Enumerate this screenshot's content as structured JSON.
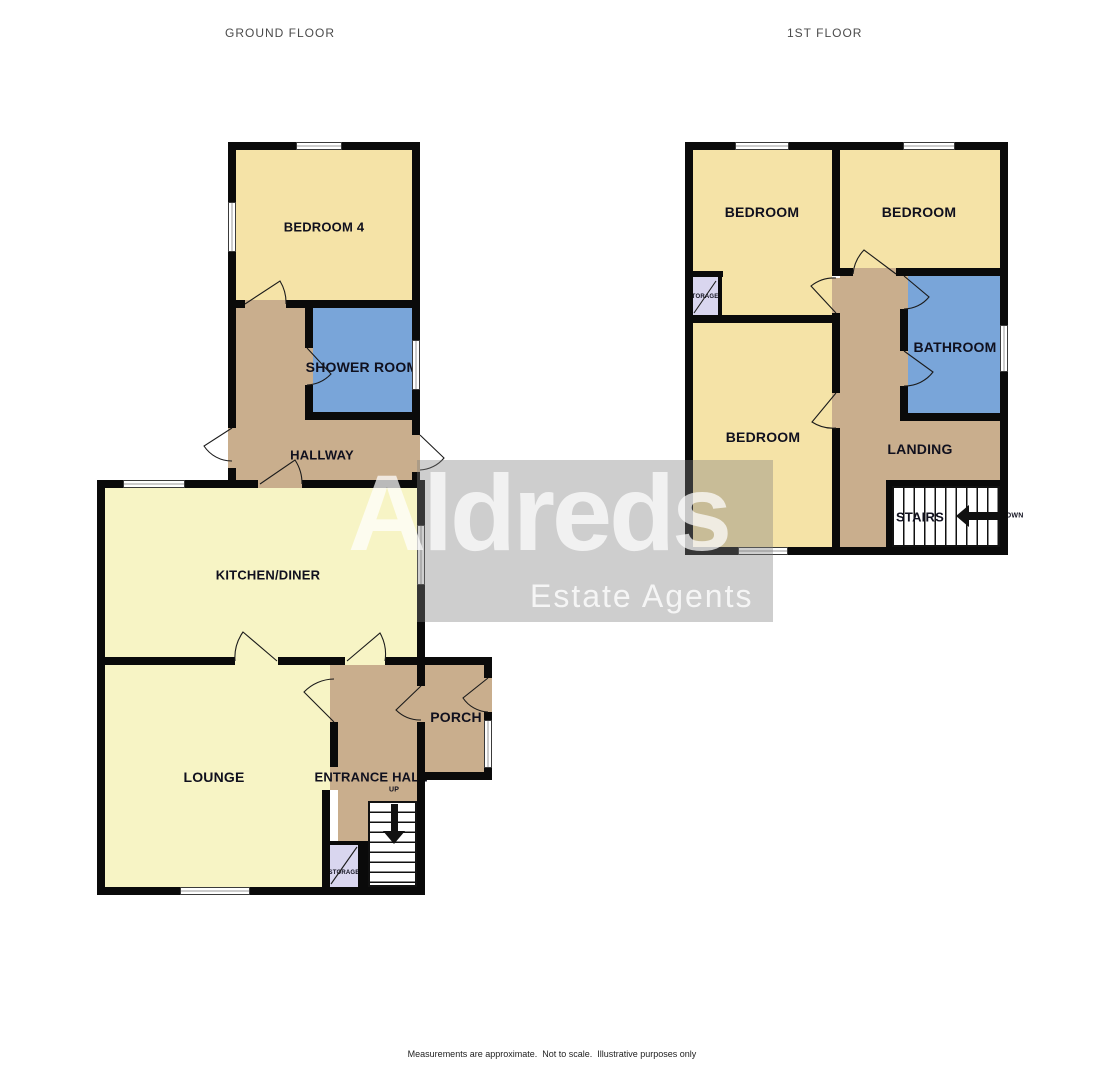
{
  "titles": {
    "ground": "GROUND FLOOR",
    "first": "1ST FLOOR"
  },
  "watermark": {
    "brand": "Aldreds",
    "tagline": "Estate Agents"
  },
  "footer": {
    "line1": "Measurements are approximate.  Not to scale.  Illustrative purposes only",
    "line2": "Made with Metropix ©2025"
  },
  "colors": {
    "wall": "#0a0a0a",
    "cream": "#F5E3A7",
    "pale": "#F7F4C5",
    "blue": "#79A5D9",
    "tan": "#C9AE8D",
    "lavender": "#D9D6EF"
  },
  "plans": [
    {
      "id": "ground-floor",
      "rooms": [
        {
          "id": "bedroom-4",
          "fill": "cream",
          "r": [
            236,
            150,
            176,
            150
          ]
        },
        {
          "id": "shower-room",
          "fill": "blue",
          "r": [
            313,
            308,
            99,
            104
          ]
        },
        {
          "id": "hallway-upper",
          "fill": "tan",
          "r": [
            236,
            308,
            69,
            112
          ]
        },
        {
          "id": "hallway-lower",
          "fill": "tan",
          "r": [
            236,
            420,
            176,
            60
          ]
        },
        {
          "id": "kitchen-diner",
          "fill": "pale",
          "r": [
            105,
            488,
            312,
            169
          ]
        },
        {
          "id": "lounge",
          "fill": "pale",
          "r": [
            105,
            665,
            225,
            222
          ]
        },
        {
          "id": "entrance-hall",
          "fill": "tan",
          "r": [
            338,
            665,
            79,
            222
          ]
        },
        {
          "id": "porch",
          "fill": "tan",
          "r": [
            425,
            665,
            59,
            107
          ]
        },
        {
          "id": "storage-ground",
          "fill": "lavender",
          "r": [
            330,
            845,
            28,
            42
          ]
        }
      ],
      "walls": [
        [
          228,
          142,
          68,
          8
        ],
        [
          342,
          142,
          78,
          8
        ],
        [
          228,
          142,
          8,
          60
        ],
        [
          228,
          252,
          8,
          176
        ],
        [
          228,
          468,
          8,
          20
        ],
        [
          412,
          142,
          8,
          198
        ],
        [
          412,
          390,
          8,
          45
        ],
        [
          412,
          472,
          8,
          16
        ],
        [
          228,
          300,
          17,
          8
        ],
        [
          286,
          300,
          126,
          8
        ],
        [
          305,
          308,
          8,
          40
        ],
        [
          305,
          385,
          8,
          27
        ],
        [
          305,
          412,
          107,
          8
        ],
        [
          97,
          480,
          161,
          8
        ],
        [
          302,
          480,
          123,
          8
        ],
        [
          97,
          480,
          8,
          185
        ],
        [
          417,
          480,
          8,
          45
        ],
        [
          417,
          585,
          8,
          80
        ],
        [
          97,
          657,
          138,
          8
        ],
        [
          278,
          657,
          67,
          8
        ],
        [
          385,
          657,
          40,
          8
        ],
        [
          97,
          657,
          8,
          238
        ],
        [
          97,
          887,
          83,
          8
        ],
        [
          250,
          887,
          175,
          8
        ],
        [
          330,
          722,
          8,
          45
        ],
        [
          322,
          790,
          8,
          97
        ],
        [
          417,
          657,
          8,
          29
        ],
        [
          417,
          722,
          8,
          165
        ],
        [
          417,
          657,
          75,
          8
        ],
        [
          484,
          657,
          8,
          21
        ],
        [
          484,
          712,
          8,
          8
        ],
        [
          484,
          768,
          8,
          12
        ],
        [
          417,
          772,
          75,
          8
        ],
        [
          323,
          841,
          45,
          4
        ],
        [
          358,
          841,
          10,
          46
        ]
      ],
      "gaps": [
        {
          "r": [
            245,
            300,
            41,
            8
          ],
          "fill": "tan"
        },
        {
          "r": [
            305,
            348,
            8,
            37
          ],
          "fill": "tan"
        },
        {
          "r": [
            228,
            428,
            8,
            40
          ],
          "fill": "tan"
        },
        {
          "r": [
            412,
            435,
            8,
            37
          ],
          "fill": "tan"
        },
        {
          "r": [
            258,
            480,
            44,
            8
          ],
          "fill": "tan"
        },
        {
          "r": [
            235,
            657,
            43,
            8
          ],
          "fill": "pale"
        },
        {
          "r": [
            345,
            657,
            40,
            8
          ],
          "fill": "pale"
        },
        {
          "r": [
            330,
            665,
            8,
            57
          ],
          "fill": "tan"
        },
        {
          "r": [
            330,
            767,
            8,
            23
          ],
          "fill": "tan"
        },
        {
          "r": [
            417,
            686,
            8,
            36
          ],
          "fill": "tan"
        },
        {
          "r": [
            484,
            678,
            8,
            34
          ],
          "fill": "tan"
        }
      ],
      "windows": [
        {
          "r": [
            296,
            142,
            46,
            8
          ],
          "o": "h"
        },
        {
          "r": [
            228,
            202,
            8,
            50
          ],
          "o": "v"
        },
        {
          "r": [
            412,
            340,
            8,
            50
          ],
          "o": "v"
        },
        {
          "r": [
            123,
            480,
            62,
            8
          ],
          "o": "h"
        },
        {
          "r": [
            417,
            525,
            8,
            60
          ],
          "o": "v"
        },
        {
          "r": [
            180,
            887,
            70,
            8
          ],
          "o": "h"
        },
        {
          "r": [
            484,
            720,
            8,
            48
          ],
          "o": "v"
        }
      ],
      "doors": [
        {
          "h": [
            245,
            304
          ],
          "o": [
            280,
            281
          ],
          "c": [
            286,
            304
          ],
          "s": 1
        },
        {
          "h": [
            307,
            348
          ],
          "o": [
            331,
            374
          ],
          "c": [
            307,
            385
          ],
          "s": 1
        },
        {
          "h": [
            232,
            428
          ],
          "o": [
            204,
            446
          ],
          "c": [
            232,
            461
          ],
          "s": 0
        },
        {
          "h": [
            420,
            435
          ],
          "o": [
            444,
            458
          ],
          "c": [
            420,
            470
          ],
          "s": 1
        },
        {
          "h": [
            260,
            484
          ],
          "o": [
            295,
            460
          ],
          "c": [
            302,
            484
          ],
          "s": 1
        },
        {
          "h": [
            277,
            661
          ],
          "o": [
            243,
            632
          ],
          "c": [
            235,
            661
          ],
          "s": 0
        },
        {
          "h": [
            347,
            661
          ],
          "o": [
            380,
            633
          ],
          "c": [
            385,
            661
          ],
          "s": 1
        },
        {
          "h": [
            334,
            722
          ],
          "o": [
            304,
            692
          ],
          "c": [
            334,
            679
          ],
          "s": 1
        },
        {
          "h": [
            421,
            686
          ],
          "o": [
            396,
            710
          ],
          "c": [
            421,
            720
          ],
          "s": 0
        },
        {
          "h": [
            488,
            678
          ],
          "o": [
            463,
            698
          ],
          "c": [
            488,
            712
          ],
          "s": 0
        }
      ],
      "leaves": [
        {
          "a": [
            331,
            884
          ],
          "b": [
            357,
            847
          ]
        }
      ],
      "stairs": [
        {
          "r": [
            368,
            801,
            49,
            86
          ],
          "dir": "h",
          "tail": [
            391,
            804,
            7,
            27
          ],
          "head": {
            "x": 383,
            "y": 831,
            "dir": "down"
          }
        }
      ],
      "labels": [
        {
          "t": "BEDROOM 4",
          "x": 324,
          "y": 227,
          "s": 13
        },
        {
          "t": "SHOWER ROOM",
          "x": 362,
          "y": 367,
          "s": 14
        },
        {
          "t": "HALLWAY",
          "x": 322,
          "y": 455,
          "s": 13
        },
        {
          "t": "KITCHEN/DINER",
          "x": 268,
          "y": 575,
          "s": 13
        },
        {
          "t": "LOUNGE",
          "x": 214,
          "y": 777,
          "s": 14
        },
        {
          "t": "ENTRANCE HALL",
          "x": 371,
          "y": 777,
          "s": 13
        },
        {
          "t": "UP",
          "x": 394,
          "y": 790,
          "s": 7
        },
        {
          "t": "STORAGE",
          "x": 344,
          "y": 873,
          "s": 6
        },
        {
          "t": "PORCH",
          "x": 456,
          "y": 717,
          "s": 14
        }
      ]
    },
    {
      "id": "first-floor",
      "rooms": [
        {
          "id": "bedroom-front-left",
          "fill": "cream",
          "r": [
            693,
            150,
            139,
            165
          ]
        },
        {
          "id": "bedroom-front-right",
          "fill": "cream",
          "r": [
            840,
            150,
            160,
            118
          ]
        },
        {
          "id": "bedroom-rear",
          "fill": "cream",
          "r": [
            693,
            322,
            139,
            225
          ]
        },
        {
          "id": "bathroom",
          "fill": "blue",
          "r": [
            908,
            276,
            92,
            137
          ]
        },
        {
          "id": "landing-strip",
          "fill": "tan",
          "r": [
            840,
            276,
            60,
            137
          ]
        },
        {
          "id": "landing-main",
          "fill": "tan",
          "r": [
            840,
            413,
            160,
            67
          ]
        },
        {
          "id": "landing-lower",
          "fill": "tan",
          "r": [
            840,
            480,
            46,
            67
          ]
        },
        {
          "id": "storage-first",
          "fill": "lavender",
          "r": [
            693,
            277,
            25,
            38
          ]
        }
      ],
      "walls": [
        [
          685,
          142,
          50,
          8
        ],
        [
          789,
          142,
          114,
          8
        ],
        [
          955,
          142,
          53,
          8
        ],
        [
          685,
          142,
          8,
          413
        ],
        [
          1000,
          142,
          8,
          183
        ],
        [
          1000,
          372,
          8,
          183
        ],
        [
          685,
          547,
          53,
          8
        ],
        [
          788,
          547,
          220,
          8
        ],
        [
          832,
          142,
          8,
          126
        ],
        [
          832,
          268,
          21,
          8
        ],
        [
          896,
          268,
          112,
          8
        ],
        [
          832,
          313,
          8,
          80
        ],
        [
          832,
          428,
          8,
          119
        ],
        [
          685,
          315,
          147,
          8
        ],
        [
          685,
          271,
          38,
          6
        ],
        [
          718,
          277,
          4,
          45
        ],
        [
          900,
          309,
          8,
          42
        ],
        [
          900,
          386,
          8,
          27
        ],
        [
          900,
          413,
          100,
          8
        ],
        [
          886,
          480,
          114,
          6
        ],
        [
          886,
          486,
          6,
          61
        ]
      ],
      "gaps": [
        {
          "r": [
            853,
            268,
            43,
            8
          ],
          "fill": "tan"
        },
        {
          "r": [
            832,
            278,
            8,
            35
          ],
          "fill": "tan"
        },
        {
          "r": [
            832,
            393,
            8,
            35
          ],
          "fill": "tan"
        },
        {
          "r": [
            900,
            276,
            8,
            33
          ],
          "fill": "tan"
        },
        {
          "r": [
            900,
            351,
            8,
            35
          ],
          "fill": "tan"
        }
      ],
      "windows": [
        {
          "r": [
            735,
            142,
            54,
            8
          ],
          "o": "h"
        },
        {
          "r": [
            903,
            142,
            52,
            8
          ],
          "o": "h"
        },
        {
          "r": [
            1000,
            325,
            8,
            47
          ],
          "o": "v"
        },
        {
          "r": [
            738,
            547,
            50,
            8
          ],
          "o": "h"
        }
      ],
      "doors": [
        {
          "h": [
            896,
            274
          ],
          "o": [
            864,
            250
          ],
          "c": [
            853,
            274
          ],
          "s": 0
        },
        {
          "h": [
            836,
            313
          ],
          "o": [
            811,
            286
          ],
          "c": [
            836,
            278
          ],
          "s": 1
        },
        {
          "h": [
            836,
            393
          ],
          "o": [
            812,
            422
          ],
          "c": [
            836,
            428
          ],
          "s": 0
        },
        {
          "h": [
            904,
            276
          ],
          "o": [
            929,
            297
          ],
          "c": [
            904,
            309
          ],
          "s": 1
        },
        {
          "h": [
            904,
            351
          ],
          "o": [
            933,
            372
          ],
          "c": [
            904,
            386
          ],
          "s": 1
        }
      ],
      "leaves": [
        {
          "a": [
            694,
            313
          ],
          "b": [
            716,
            281
          ]
        }
      ],
      "stairs": [
        {
          "r": [
            892,
            486,
            108,
            61
          ],
          "dir": "v",
          "tail": [
            969,
            512,
            31,
            8
          ],
          "head": {
            "x": 956,
            "y": 505,
            "dir": "left"
          }
        }
      ],
      "labels": [
        {
          "t": "BEDROOM",
          "x": 762,
          "y": 212,
          "s": 14
        },
        {
          "t": "BEDROOM",
          "x": 919,
          "y": 212,
          "s": 14
        },
        {
          "t": "BEDROOM",
          "x": 763,
          "y": 437,
          "s": 14
        },
        {
          "t": "BATHROOM",
          "x": 955,
          "y": 347,
          "s": 14
        },
        {
          "t": "LANDING",
          "x": 920,
          "y": 449,
          "s": 14
        },
        {
          "t": "STAIRS",
          "x": 920,
          "y": 517,
          "s": 13
        },
        {
          "t": "STORAGE",
          "x": 703,
          "y": 297,
          "s": 6
        },
        {
          "t": "DOWN",
          "x": 1012,
          "y": 516,
          "s": 7
        }
      ]
    }
  ]
}
